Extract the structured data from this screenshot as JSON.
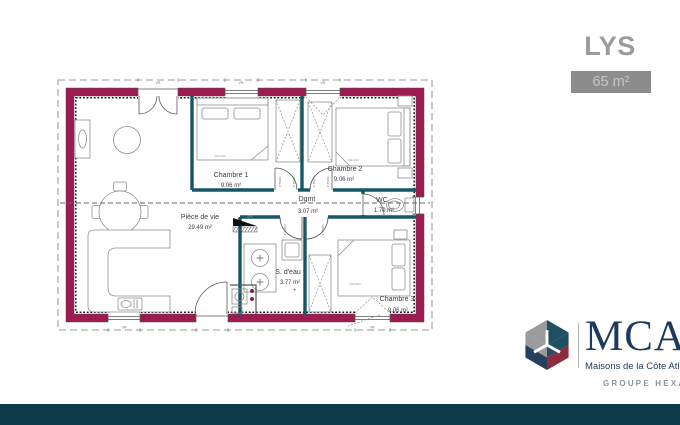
{
  "header": {
    "title": "LYS",
    "area_badge": "65 m²"
  },
  "plan": {
    "rooms": [
      {
        "name": "Pièce de vie",
        "area": "29.49 m²"
      },
      {
        "name": "Chambre 1",
        "area": "9.06 m²"
      },
      {
        "name": "Chambre 2",
        "area": "9.06 m²"
      },
      {
        "name": "Chambre 3",
        "area": "9.06 m²"
      },
      {
        "name": "Dgmt",
        "area": "3.07 m²"
      },
      {
        "name": "WC",
        "area": "1.70 m²"
      },
      {
        "name": "S. d'eau",
        "area": "3.77 m²"
      }
    ],
    "annotations": {
      "electric_panel": "EDF",
      "door_spec": "P 75204",
      "bed_size": "140x200",
      "shutter": "VR"
    }
  },
  "logo": {
    "brand": "MCA",
    "tagline": "Maisons de la Côte Atlantique",
    "group": "GROUPE HEXAOM"
  },
  "colors": {
    "exterior_wall": "#9e1b51",
    "partition": "#155764",
    "footer_bar": "#0d3a49",
    "logo_navy": "#1d3b5d",
    "logo_red": "#8e2c3e",
    "logo_gray": "#9b9b9d",
    "badge_bg": "#8d8d8d"
  }
}
